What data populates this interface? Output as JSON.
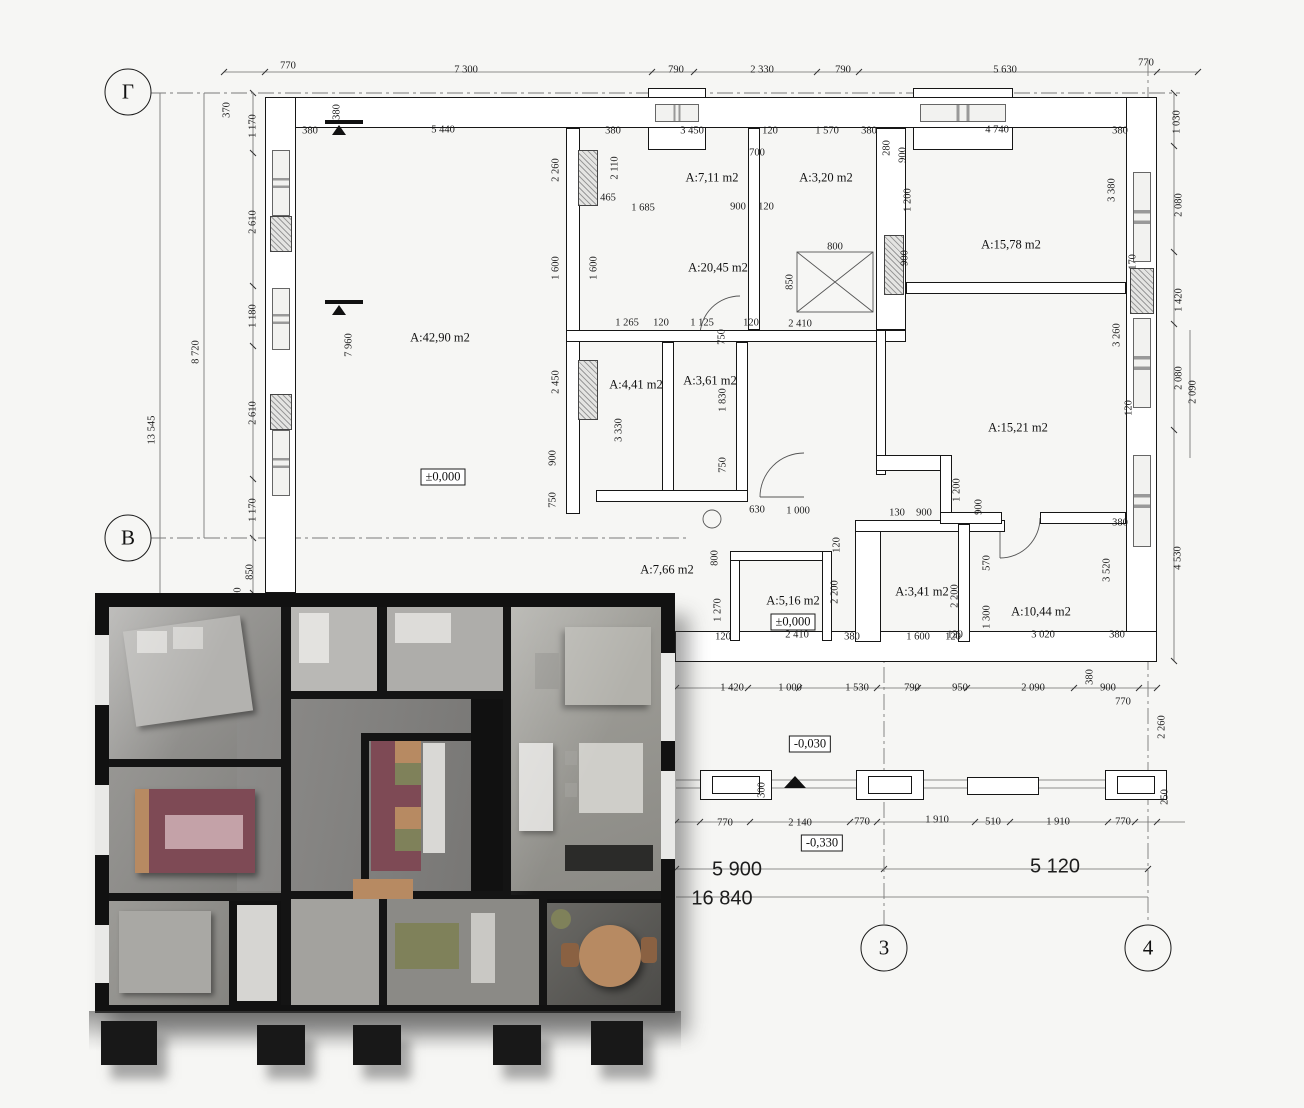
{
  "palette": {
    "paper": "#f6f6f4",
    "line": "#1c1c1c",
    "render-wall": "#141414",
    "render-floor": "#93928e",
    "accent-maroon": "#7e4a55",
    "accent-green": "#7f815a",
    "accent-wood": "#b78a62"
  },
  "drawing": {
    "axes": [
      {
        "label": "Г",
        "x": 128,
        "y": 92
      },
      {
        "label": "В",
        "x": 128,
        "y": 538
      },
      {
        "label": "3",
        "x": 884,
        "y": 948
      },
      {
        "label": "4",
        "x": 1148,
        "y": 948
      }
    ],
    "rooms": [
      {
        "t": "A:42,90 m2",
        "x": 440,
        "y": 338
      },
      {
        "t": "A:7,11 m2",
        "x": 712,
        "y": 178
      },
      {
        "t": "A:3,20 m2",
        "x": 826,
        "y": 178
      },
      {
        "t": "A:20,45 m2",
        "x": 718,
        "y": 268
      },
      {
        "t": "A:15,78 m2",
        "x": 1011,
        "y": 245
      },
      {
        "t": "A:15,21 m2",
        "x": 1018,
        "y": 428
      },
      {
        "t": "A:4,41 m2",
        "x": 636,
        "y": 385
      },
      {
        "t": "A:3,61 m2",
        "x": 710,
        "y": 381
      },
      {
        "t": "A:7,66 m2",
        "x": 667,
        "y": 570
      },
      {
        "t": "A:5,16 m2",
        "x": 793,
        "y": 601
      },
      {
        "t": "A:3,41 m2",
        "x": 922,
        "y": 592
      },
      {
        "t": "A:10,44 m2",
        "x": 1041,
        "y": 612
      }
    ],
    "elevations": [
      {
        "t": "±0,000",
        "x": 443,
        "y": 477
      },
      {
        "t": "±0,000",
        "x": 793,
        "y": 622
      },
      {
        "t": "-0,030",
        "x": 810,
        "y": 744
      },
      {
        "t": "-0,330",
        "x": 822,
        "y": 843
      }
    ],
    "totals": [
      {
        "t": "5 900",
        "x": 737,
        "y": 870
      },
      {
        "t": "5 120",
        "x": 1055,
        "y": 867
      },
      {
        "t": "16 840",
        "x": 722,
        "y": 899
      }
    ],
    "dims": [
      {
        "t": "770",
        "x": 288,
        "y": 66
      },
      {
        "t": "7 300",
        "x": 466,
        "y": 70
      },
      {
        "t": "790",
        "x": 676,
        "y": 70
      },
      {
        "t": "2 330",
        "x": 762,
        "y": 70
      },
      {
        "t": "790",
        "x": 843,
        "y": 70
      },
      {
        "t": "5 630",
        "x": 1005,
        "y": 70
      },
      {
        "t": "770",
        "x": 1146,
        "y": 63
      },
      {
        "t": "380",
        "x": 310,
        "y": 131
      },
      {
        "t": "5 440",
        "x": 443,
        "y": 130
      },
      {
        "t": "380",
        "x": 613,
        "y": 131
      },
      {
        "t": "3 450",
        "x": 692,
        "y": 131
      },
      {
        "t": "120",
        "x": 770,
        "y": 131
      },
      {
        "t": "1 570",
        "x": 827,
        "y": 131
      },
      {
        "t": "380",
        "x": 869,
        "y": 131
      },
      {
        "t": "280",
        "x": 887,
        "y": 148,
        "r": -90
      },
      {
        "t": "4 740",
        "x": 997,
        "y": 130
      },
      {
        "t": "380",
        "x": 1120,
        "y": 131
      },
      {
        "t": "380",
        "x": 337,
        "y": 112,
        "r": -90
      },
      {
        "t": "370",
        "x": 227,
        "y": 110,
        "r": -90
      },
      {
        "t": "13 545",
        "x": 152,
        "y": 430,
        "r": -90
      },
      {
        "t": "8 720",
        "x": 196,
        "y": 352,
        "r": -90
      },
      {
        "t": "1 170",
        "x": 253,
        "y": 126,
        "r": -90
      },
      {
        "t": "2 610",
        "x": 253,
        "y": 222,
        "r": -90
      },
      {
        "t": "1 180",
        "x": 253,
        "y": 316,
        "r": -90
      },
      {
        "t": "2 610",
        "x": 253,
        "y": 413,
        "r": -90
      },
      {
        "t": "1 170",
        "x": 253,
        "y": 510,
        "r": -90
      },
      {
        "t": "850",
        "x": 250,
        "y": 572,
        "r": -90
      },
      {
        "t": "0",
        "x": 238,
        "y": 590,
        "r": -90
      },
      {
        "t": "2 260",
        "x": 556,
        "y": 170,
        "r": -90
      },
      {
        "t": "1 600",
        "x": 556,
        "y": 268,
        "r": -90
      },
      {
        "t": "2 450",
        "x": 556,
        "y": 382,
        "r": -90
      },
      {
        "t": "900",
        "x": 553,
        "y": 458,
        "r": -90
      },
      {
        "t": "750",
        "x": 553,
        "y": 500,
        "r": -90
      },
      {
        "t": "2 110",
        "x": 615,
        "y": 168,
        "r": -90
      },
      {
        "t": "465",
        "x": 608,
        "y": 198
      },
      {
        "t": "1 600",
        "x": 594,
        "y": 268,
        "r": -90
      },
      {
        "t": "7 960",
        "x": 349,
        "y": 345,
        "r": -90
      },
      {
        "t": "700",
        "x": 757,
        "y": 153
      },
      {
        "t": "1 685",
        "x": 643,
        "y": 208
      },
      {
        "t": "900",
        "x": 738,
        "y": 207
      },
      {
        "t": "120",
        "x": 766,
        "y": 207
      },
      {
        "t": "900",
        "x": 903,
        "y": 155,
        "r": -90
      },
      {
        "t": "1 200",
        "x": 908,
        "y": 200,
        "r": -90
      },
      {
        "t": "900",
        "x": 905,
        "y": 258,
        "r": -90
      },
      {
        "t": "800",
        "x": 835,
        "y": 247
      },
      {
        "t": "850",
        "x": 790,
        "y": 282,
        "r": -90
      },
      {
        "t": "1 265",
        "x": 627,
        "y": 323
      },
      {
        "t": "120",
        "x": 661,
        "y": 323
      },
      {
        "t": "1 125",
        "x": 702,
        "y": 323
      },
      {
        "t": "120",
        "x": 751,
        "y": 323
      },
      {
        "t": "2 410",
        "x": 800,
        "y": 324
      },
      {
        "t": "750",
        "x": 722,
        "y": 337,
        "r": -90
      },
      {
        "t": "1 830",
        "x": 723,
        "y": 400,
        "r": -90
      },
      {
        "t": "750",
        "x": 723,
        "y": 465,
        "r": -90
      },
      {
        "t": "3 330",
        "x": 619,
        "y": 430,
        "r": -90
      },
      {
        "t": "630",
        "x": 757,
        "y": 510
      },
      {
        "t": "1 000",
        "x": 798,
        "y": 511
      },
      {
        "t": "1 030",
        "x": 1177,
        "y": 122,
        "r": -90
      },
      {
        "t": "3 380",
        "x": 1112,
        "y": 190,
        "r": -90
      },
      {
        "t": "170",
        "x": 1133,
        "y": 262,
        "r": -90
      },
      {
        "t": "3 260",
        "x": 1117,
        "y": 335,
        "r": -90
      },
      {
        "t": "120",
        "x": 1129,
        "y": 408,
        "r": -90
      },
      {
        "t": "2 080",
        "x": 1179,
        "y": 205,
        "r": -90
      },
      {
        "t": "1 420",
        "x": 1179,
        "y": 300,
        "r": -90
      },
      {
        "t": "2 080",
        "x": 1179,
        "y": 378,
        "r": -90
      },
      {
        "t": "2 090",
        "x": 1193,
        "y": 392,
        "r": -90
      },
      {
        "t": "4 530",
        "x": 1178,
        "y": 558,
        "r": -90
      },
      {
        "t": "3 520",
        "x": 1107,
        "y": 570,
        "r": -90
      },
      {
        "t": "380",
        "x": 1120,
        "y": 523
      },
      {
        "t": "130",
        "x": 897,
        "y": 513
      },
      {
        "t": "900",
        "x": 924,
        "y": 513
      },
      {
        "t": "1 200",
        "x": 957,
        "y": 490,
        "r": -90
      },
      {
        "t": "900",
        "x": 979,
        "y": 507,
        "r": -90
      },
      {
        "t": "570",
        "x": 987,
        "y": 563,
        "r": -90
      },
      {
        "t": "1 300",
        "x": 987,
        "y": 617,
        "r": -90
      },
      {
        "t": "120",
        "x": 955,
        "y": 635
      },
      {
        "t": "3 020",
        "x": 1043,
        "y": 635
      },
      {
        "t": "380",
        "x": 1117,
        "y": 635
      },
      {
        "t": "2 200",
        "x": 835,
        "y": 592,
        "r": -90
      },
      {
        "t": "2 200",
        "x": 955,
        "y": 596,
        "r": -90
      },
      {
        "t": "120",
        "x": 837,
        "y": 545,
        "r": -90
      },
      {
        "t": "1 270",
        "x": 718,
        "y": 610,
        "r": -90
      },
      {
        "t": "800",
        "x": 715,
        "y": 558,
        "r": -90
      },
      {
        "t": "120",
        "x": 723,
        "y": 637
      },
      {
        "t": "2 410",
        "x": 797,
        "y": 635
      },
      {
        "t": "380",
        "x": 852,
        "y": 637
      },
      {
        "t": "1 600",
        "x": 918,
        "y": 637
      },
      {
        "t": "120",
        "x": 953,
        "y": 637
      },
      {
        "t": "1 420",
        "x": 732,
        "y": 688
      },
      {
        "t": "1 000",
        "x": 790,
        "y": 688
      },
      {
        "t": "1 530",
        "x": 857,
        "y": 688
      },
      {
        "t": "790",
        "x": 912,
        "y": 688
      },
      {
        "t": "950",
        "x": 960,
        "y": 688
      },
      {
        "t": "2 090",
        "x": 1033,
        "y": 688
      },
      {
        "t": "380",
        "x": 1090,
        "y": 677,
        "r": -90
      },
      {
        "t": "900",
        "x": 1108,
        "y": 688
      },
      {
        "t": "770",
        "x": 1123,
        "y": 702
      },
      {
        "t": "2 260",
        "x": 1162,
        "y": 727,
        "r": -90
      },
      {
        "t": "300",
        "x": 762,
        "y": 790,
        "r": -90
      },
      {
        "t": "770",
        "x": 725,
        "y": 823
      },
      {
        "t": "2 140",
        "x": 800,
        "y": 823
      },
      {
        "t": "770",
        "x": 862,
        "y": 822
      },
      {
        "t": "1 910",
        "x": 937,
        "y": 820
      },
      {
        "t": "510",
        "x": 993,
        "y": 822
      },
      {
        "t": "1 910",
        "x": 1058,
        "y": 822
      },
      {
        "t": "770",
        "x": 1123,
        "y": 822
      },
      {
        "t": "250",
        "x": 1165,
        "y": 797,
        "r": -90
      }
    ]
  }
}
